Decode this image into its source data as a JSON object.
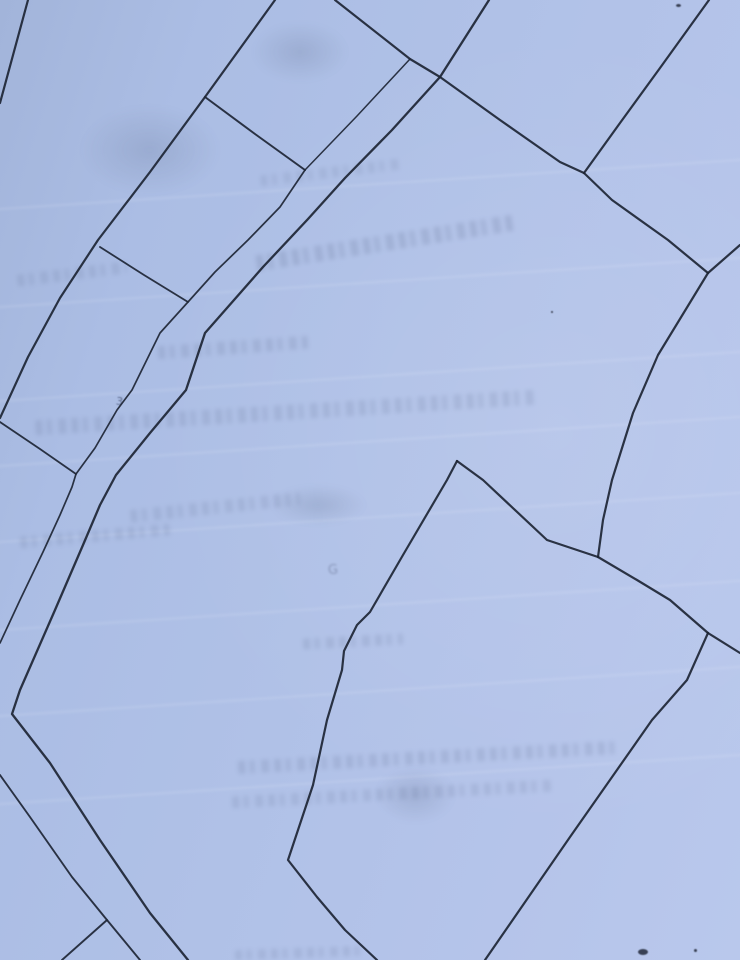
{
  "meta": {
    "description": "Photograph of a cadastral parcel map: dark ink boundary lines on light blue paper",
    "paper_color": "#b0c1e7",
    "ink_color": "#1d2534"
  },
  "map": {
    "lines": [
      {
        "name": "parcel-line-topleft-corner",
        "width": 2.2,
        "points": [
          [
            28,
            0
          ],
          [
            0,
            103
          ]
        ]
      },
      {
        "name": "parcel-line-long-west",
        "width": 2.2,
        "points": [
          [
            275,
            0
          ],
          [
            205,
            97
          ],
          [
            150,
            172
          ],
          [
            98,
            240
          ],
          [
            60,
            298
          ],
          [
            28,
            357
          ],
          [
            0,
            418
          ]
        ]
      },
      {
        "name": "parcel-connector-north",
        "width": 2.0,
        "points": [
          [
            205,
            97
          ],
          [
            255,
            134
          ],
          [
            305,
            170
          ]
        ]
      },
      {
        "name": "parcel-line-north-diagonal",
        "width": 2.2,
        "points": [
          [
            335,
            0
          ],
          [
            410,
            59
          ],
          [
            440,
            77
          ],
          [
            500,
            120
          ],
          [
            560,
            162
          ],
          [
            584,
            173
          ]
        ]
      },
      {
        "name": "parcel-connector-thin",
        "width": 1.5,
        "points": [
          [
            410,
            59
          ],
          [
            357,
            116
          ],
          [
            305,
            170
          ]
        ]
      },
      {
        "name": "road-east-edge",
        "width": 2.3,
        "points": [
          [
            489,
            0
          ],
          [
            440,
            77
          ],
          [
            392,
            130
          ],
          [
            345,
            178
          ],
          [
            308,
            219
          ],
          [
            263,
            267
          ],
          [
            205,
            333
          ],
          [
            186,
            390
          ],
          [
            150,
            433
          ],
          [
            116,
            475
          ],
          [
            100,
            505
          ],
          [
            83,
            545
          ],
          [
            55,
            610
          ],
          [
            20,
            690
          ],
          [
            12,
            714
          ],
          [
            50,
            763
          ],
          [
            100,
            840
          ],
          [
            150,
            913
          ],
          [
            188,
            960
          ]
        ]
      },
      {
        "name": "road-west-edge",
        "width": 1.7,
        "points": [
          [
            305,
            170
          ],
          [
            280,
            207
          ],
          [
            248,
            240
          ],
          [
            215,
            272
          ],
          [
            188,
            302
          ],
          [
            160,
            333
          ],
          [
            132,
            390
          ],
          [
            117,
            410
          ],
          [
            95,
            448
          ],
          [
            76,
            474
          ],
          [
            72,
            487
          ],
          [
            60,
            515
          ],
          [
            43,
            552
          ],
          [
            20,
            600
          ],
          [
            0,
            643
          ]
        ]
      },
      {
        "name": "parcel-connector-mid",
        "width": 1.8,
        "points": [
          [
            100,
            247
          ],
          [
            144,
            275
          ],
          [
            188,
            302
          ]
        ]
      },
      {
        "name": "parcel-connector-southwest",
        "width": 1.8,
        "points": [
          [
            0,
            422
          ],
          [
            40,
            449
          ],
          [
            76,
            474
          ]
        ]
      },
      {
        "name": "parcel-line-topright",
        "width": 2.2,
        "points": [
          [
            709,
            0
          ],
          [
            660,
            68
          ],
          [
            620,
            123
          ],
          [
            584,
            173
          ]
        ]
      },
      {
        "name": "parcel-line-east-upper",
        "width": 2.2,
        "points": [
          [
            584,
            173
          ],
          [
            612,
            200
          ],
          [
            668,
            240
          ],
          [
            708,
            273
          ]
        ]
      },
      {
        "name": "parcel-line-east",
        "width": 2.2,
        "points": [
          [
            740,
            245
          ],
          [
            708,
            273
          ],
          [
            658,
            355
          ],
          [
            633,
            413
          ],
          [
            612,
            480
          ],
          [
            603,
            520
          ],
          [
            598,
            557
          ]
        ]
      },
      {
        "name": "parcel-line-valley-west",
        "width": 2.2,
        "points": [
          [
            457,
            461
          ],
          [
            447,
            480
          ],
          [
            403,
            555
          ],
          [
            370,
            612
          ],
          [
            357,
            625
          ],
          [
            344,
            651
          ],
          [
            342,
            670
          ],
          [
            327,
            720
          ],
          [
            313,
            785
          ],
          [
            288,
            860
          ],
          [
            317,
            897
          ],
          [
            345,
            930
          ],
          [
            377,
            960
          ]
        ]
      },
      {
        "name": "parcel-line-valley-east",
        "width": 2.2,
        "points": [
          [
            457,
            461
          ],
          [
            483,
            480
          ],
          [
            547,
            540
          ],
          [
            598,
            557
          ]
        ]
      },
      {
        "name": "parcel-line-southeast-mid",
        "width": 2.2,
        "points": [
          [
            598,
            557
          ],
          [
            637,
            580
          ],
          [
            670,
            600
          ],
          [
            708,
            633
          ]
        ]
      },
      {
        "name": "parcel-line-east-exit",
        "width": 2.2,
        "points": [
          [
            708,
            633
          ],
          [
            740,
            653
          ]
        ]
      },
      {
        "name": "parcel-line-south-diagonal",
        "width": 2.2,
        "points": [
          [
            708,
            633
          ],
          [
            687,
            680
          ],
          [
            652,
            720
          ],
          [
            570,
            837
          ],
          [
            485,
            960
          ]
        ]
      },
      {
        "name": "road-south-west-edge",
        "width": 1.9,
        "points": [
          [
            0,
            775
          ],
          [
            30,
            817
          ],
          [
            72,
            877
          ],
          [
            107,
            920
          ],
          [
            140,
            960
          ]
        ]
      },
      {
        "name": "parcel-branch-southwest",
        "width": 1.9,
        "points": [
          [
            107,
            920
          ],
          [
            62,
            960
          ]
        ]
      }
    ],
    "marks": [
      {
        "name": "handwritten-digit",
        "text": "3",
        "x": 116,
        "y": 396,
        "size": 11,
        "rotate": 8,
        "opacity": 0.75,
        "blur": 0.4
      },
      {
        "name": "handwritten-letter-g",
        "text": "G",
        "x": 328,
        "y": 564,
        "size": 13,
        "rotate": -4,
        "opacity": 0.38,
        "blur": 1.0
      }
    ],
    "watermarks": [
      {
        "name": "ghost-text-band",
        "cx": 330,
        "cy": 172,
        "w": 140,
        "h": 11,
        "rot": -7,
        "opacity": 0.3
      },
      {
        "name": "ghost-text-band",
        "cx": 385,
        "cy": 243,
        "w": 260,
        "h": 16,
        "rot": -9,
        "opacity": 0.45
      },
      {
        "name": "ghost-text-band",
        "cx": 72,
        "cy": 274,
        "w": 110,
        "h": 12,
        "rot": -7,
        "opacity": 0.35
      },
      {
        "name": "ghost-text-band",
        "cx": 233,
        "cy": 347,
        "w": 150,
        "h": 13,
        "rot": -4,
        "opacity": 0.4
      },
      {
        "name": "ghost-text-band",
        "cx": 285,
        "cy": 412,
        "w": 500,
        "h": 15,
        "rot": -3.5,
        "opacity": 0.38
      },
      {
        "name": "ghost-text-band",
        "cx": 95,
        "cy": 536,
        "w": 150,
        "h": 12,
        "rot": -5,
        "opacity": 0.35
      },
      {
        "name": "ghost-text-band",
        "cx": 215,
        "cy": 507,
        "w": 170,
        "h": 13,
        "rot": -6,
        "opacity": 0.35
      },
      {
        "name": "ghost-text-band",
        "cx": 353,
        "cy": 641,
        "w": 100,
        "h": 11,
        "rot": -3,
        "opacity": 0.38
      },
      {
        "name": "ghost-text-band",
        "cx": 428,
        "cy": 757,
        "w": 380,
        "h": 13,
        "rot": -3,
        "opacity": 0.4
      },
      {
        "name": "ghost-text-band",
        "cx": 392,
        "cy": 794,
        "w": 320,
        "h": 12,
        "rot": -3,
        "opacity": 0.35
      },
      {
        "name": "ghost-text-band",
        "cx": 300,
        "cy": 953,
        "w": 130,
        "h": 10,
        "rot": -2,
        "opacity": 0.35
      }
    ],
    "creases": [
      {
        "name": "paper-crease",
        "y": 183
      },
      {
        "name": "paper-crease",
        "y": 281
      },
      {
        "name": "paper-crease",
        "y": 375
      },
      {
        "name": "paper-crease",
        "y": 440
      },
      {
        "name": "paper-crease",
        "y": 516
      },
      {
        "name": "paper-crease",
        "y": 604
      },
      {
        "name": "paper-crease",
        "y": 690
      },
      {
        "name": "paper-crease",
        "y": 778
      }
    ],
    "stains": [
      {
        "name": "paper-stain",
        "cx": 300,
        "cy": 52,
        "rx": 48,
        "ry": 30
      },
      {
        "name": "paper-stain",
        "cx": 150,
        "cy": 150,
        "rx": 70,
        "ry": 45
      },
      {
        "name": "paper-stain",
        "cx": 318,
        "cy": 505,
        "rx": 48,
        "ry": 20
      },
      {
        "name": "paper-stain",
        "cx": 415,
        "cy": 795,
        "rx": 40,
        "ry": 28
      }
    ],
    "specks": [
      {
        "name": "ink-speck",
        "x": 676,
        "y": 4,
        "w": 5,
        "h": 3
      },
      {
        "name": "ink-speck",
        "x": 551,
        "y": 311,
        "w": 2,
        "h": 2
      },
      {
        "name": "ink-speck",
        "x": 638,
        "y": 949,
        "w": 10,
        "h": 6
      },
      {
        "name": "ink-speck",
        "x": 694,
        "y": 949,
        "w": 3,
        "h": 3
      }
    ]
  }
}
